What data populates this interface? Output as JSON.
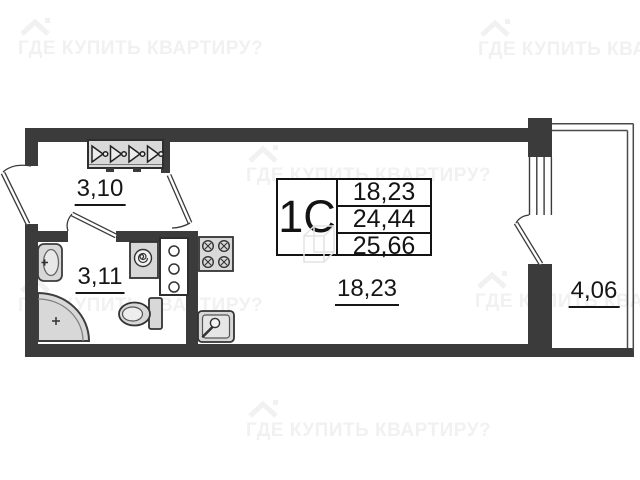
{
  "watermark": {
    "text": "ГДЕ КУПИТЬ КВАРТИРУ?"
  },
  "unit_table": {
    "type_label": "1С",
    "rows": [
      {
        "value": "18,23"
      },
      {
        "value": "24,44"
      },
      {
        "value": "25,66"
      }
    ]
  },
  "rooms": [
    {
      "name": "hallway",
      "area": "3,10"
    },
    {
      "name": "bathroom",
      "area": "3,11"
    },
    {
      "name": "living-room",
      "area": "18,23"
    },
    {
      "name": "balcony",
      "area": "4,06"
    }
  ],
  "colors": {
    "wall": "#3b3b3b",
    "fixture_fill": "#d8d8d8",
    "fixture_stroke": "#3d3d3d",
    "text": "#161616",
    "watermark": "#f1f1f1",
    "background": "#ffffff"
  }
}
